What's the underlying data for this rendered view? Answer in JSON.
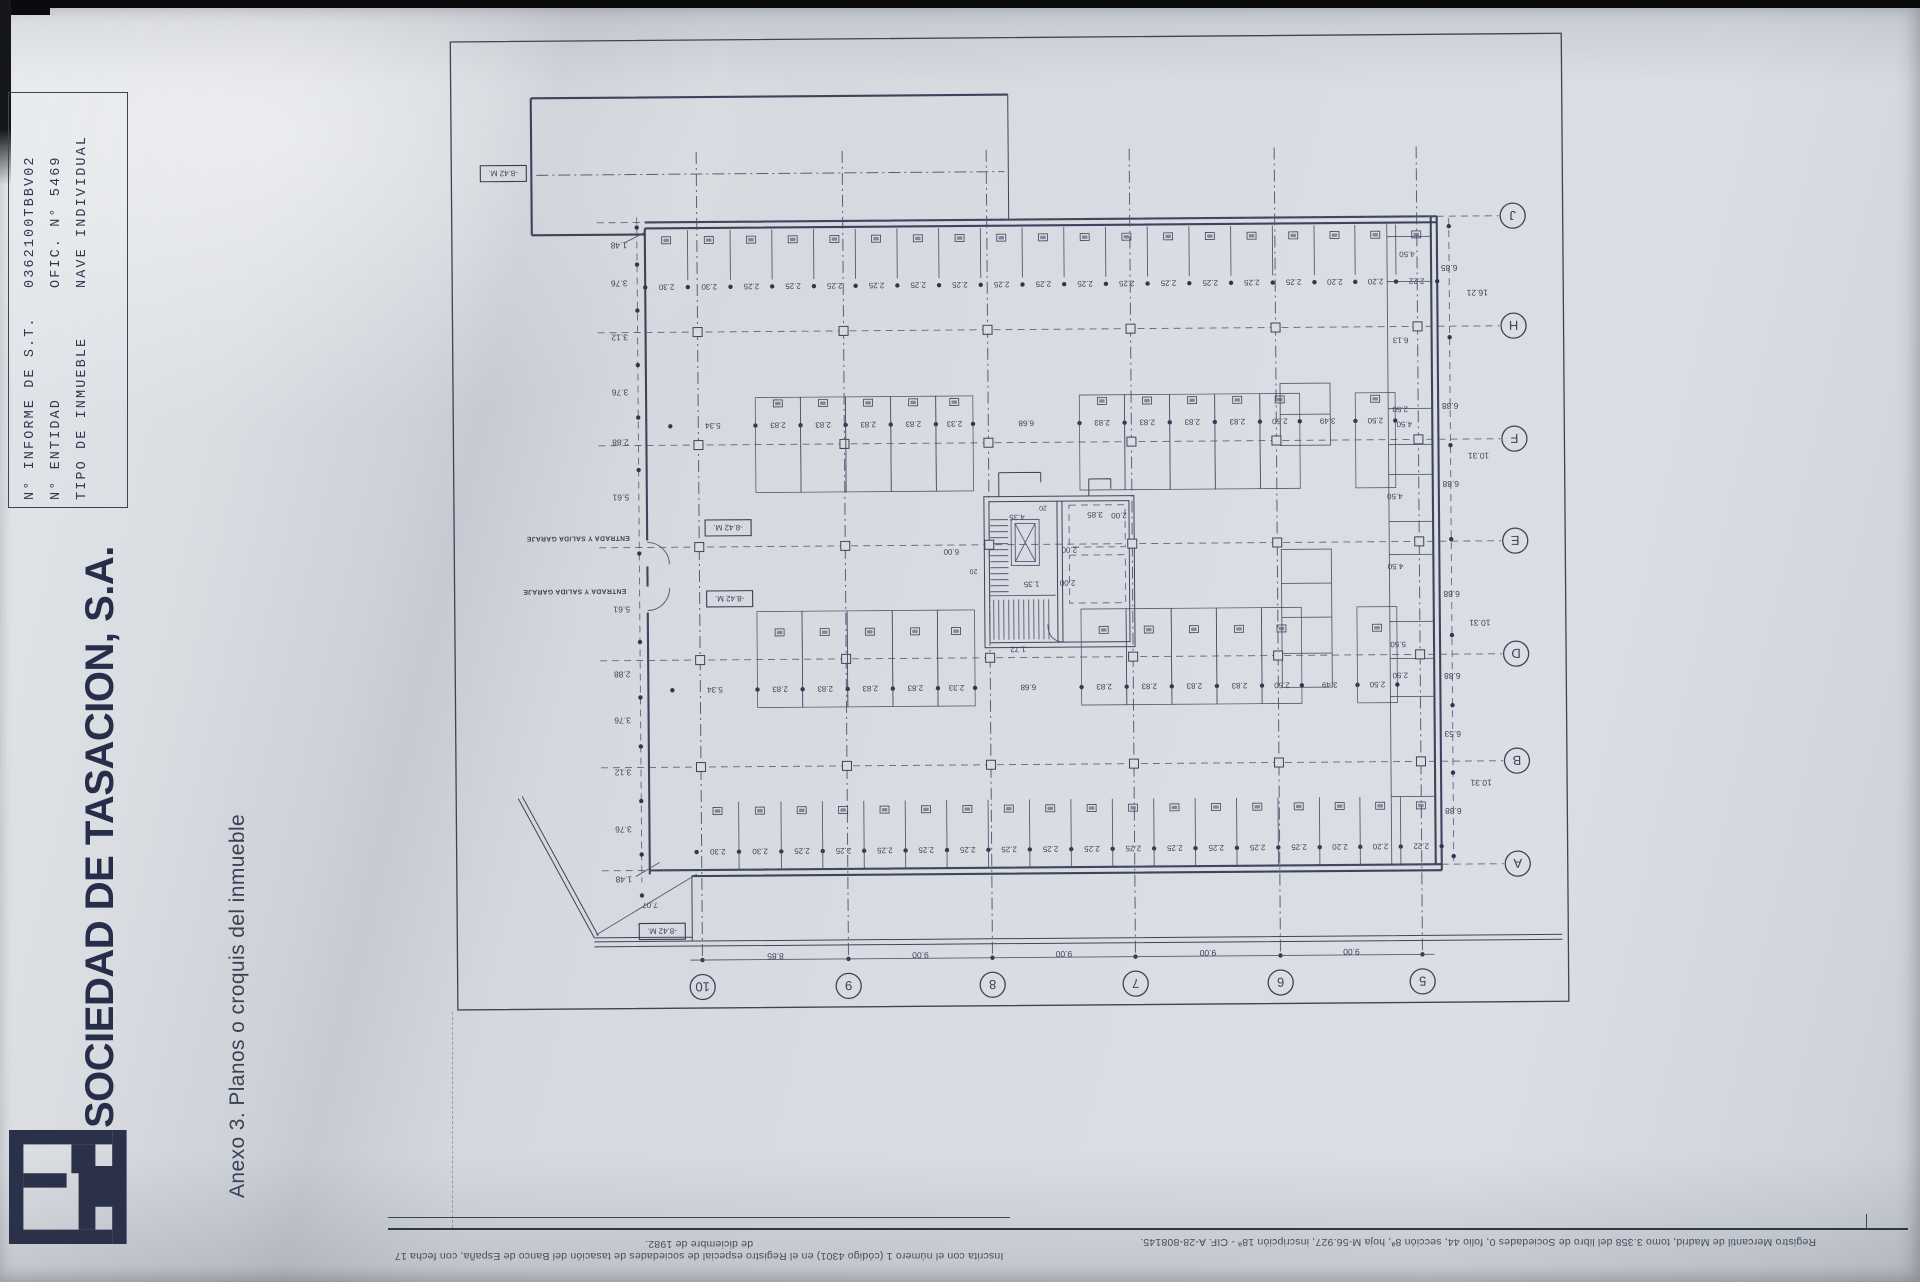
{
  "page": {
    "header": {
      "labels": [
        "N° INFORME DE S.T.",
        "N° ENTIDAD",
        "TIPO DE INMUEBLE"
      ],
      "values": [
        "0362100TBBV02",
        "OFIC. N° 5469",
        "NAVE INDIVIDUAL"
      ]
    },
    "company": "SOCIEDAD DE TASACION, S.A.",
    "annex_title": "Anexo 3. Planos o croquis del inmueble",
    "footer_left": "Inscrita con el número 1 (código 4301) en el Registro especial de sociedades de tasación del Banco de España, con fecha 17 de diciembre de 1982.",
    "footer_right": "Registro Mercantil de Madrid, tomo 3.358 del libro de Sociedades 0, folio 44, sección 8ª, hoja M-56.927, inscripción 18ª - CIF. A-28-808145."
  },
  "colors": {
    "ink": "#272e49",
    "drawing": "#3c4359"
  },
  "plan": {
    "grid_columns": [
      {
        "label": "10",
        "x": 700
      },
      {
        "label": "9",
        "x": 846
      },
      {
        "label": "8",
        "x": 990
      },
      {
        "label": "7",
        "x": 1133
      },
      {
        "label": "6",
        "x": 1278
      },
      {
        "label": "5",
        "x": 1420
      }
    ],
    "grid_rows": [
      {
        "label": "J",
        "y": 220
      },
      {
        "label": "H",
        "y": 330
      },
      {
        "label": "F",
        "y": 443
      },
      {
        "label": "E",
        "y": 545
      },
      {
        "label": "D",
        "y": 658
      },
      {
        "label": "B",
        "y": 765
      },
      {
        "label": "A",
        "y": 868
      }
    ],
    "bottom_chain": [
      "8.85",
      "9.00",
      "9.00",
      "9.00",
      "9.00"
    ],
    "right_inner_chain": [
      {
        "text": "6.85",
        "y": 272
      },
      {
        "text": "6.88",
        "y": 410
      },
      {
        "text": "6.88",
        "y": 488
      },
      {
        "text": "6.88",
        "y": 598
      },
      {
        "text": "6.88",
        "y": 680
      },
      {
        "text": "6.53",
        "y": 738
      },
      {
        "text": "6.88",
        "y": 815
      }
    ],
    "right_outer_chain": [
      {
        "text": "16.21",
        "y": 297
      },
      {
        "text": "10.31",
        "y": 460
      },
      {
        "text": "10.31",
        "y": 627
      },
      {
        "text": "10.31",
        "y": 787
      }
    ],
    "left_chain": [
      {
        "text": "1.48",
        "y": 243
      },
      {
        "text": "3.76",
        "y": 281
      },
      {
        "text": "3.12",
        "y": 335
      },
      {
        "text": "3.76",
        "y": 390
      },
      {
        "text": "2.88",
        "y": 440
      },
      {
        "text": "5.61",
        "y": 495
      },
      {
        "text": "5.61",
        "y": 607
      },
      {
        "text": "2.88",
        "y": 672
      },
      {
        "text": "3.76",
        "y": 718
      },
      {
        "text": "3.12",
        "y": 770
      },
      {
        "text": "3.76",
        "y": 827
      },
      {
        "text": "1.48",
        "y": 877
      }
    ],
    "stall_rows": [
      {
        "name": "row-J",
        "x0": 648,
        "x1": 1440,
        "top": 228,
        "bottom": 278,
        "chain_y": 285,
        "square_y": 238,
        "segments": [
          "2.30",
          "2.30",
          "2.25",
          "2.25",
          "2.25",
          "2.25",
          "2.25",
          "2.25",
          "2.25",
          "2.25",
          "2.25",
          "2.25",
          "2.25",
          "2.25",
          "2.25",
          "2.25",
          "2.20",
          "2.20",
          "2.22"
        ]
      },
      {
        "name": "band-F",
        "x0": 672,
        "x1": 1397,
        "top": 396,
        "bottom": 491,
        "chain_y": 424,
        "square_y": 402,
        "segments": [
          "5.34",
          "2.83",
          "2.83",
          "2.83",
          "2.83",
          "2.33",
          "6.68",
          "2.83",
          "2.83",
          "2.83",
          "2.83",
          "2.50",
          "3.49",
          "2.50"
        ]
      },
      {
        "name": "band-D",
        "x0": 672,
        "x1": 1397,
        "top": 610,
        "bottom": 706,
        "chain_y": 688,
        "square_y": 631,
        "segments": [
          "5.34",
          "2.83",
          "2.83",
          "2.83",
          "2.83",
          "2.33",
          "6.68",
          "2.83",
          "2.83",
          "2.83",
          "2.83",
          "2.50",
          "3.49",
          "2.50"
        ]
      },
      {
        "name": "row-A",
        "x0": 695,
        "x1": 1440,
        "top": 800,
        "bottom": 868,
        "chain_y": 850,
        "square_y": 809,
        "segments": [
          "2.30",
          "2.30",
          "2.25",
          "2.25",
          "2.25",
          "2.25",
          "2.25",
          "2.25",
          "2.25",
          "2.25",
          "2.25",
          "2.25",
          "2.25",
          "2.25",
          "2.25",
          "2.20",
          "2.20",
          "2.22"
        ]
      }
    ],
    "elevation_boxes": [
      {
        "text": "-8.42 M.",
        "x": 507,
        "y": 170
      },
      {
        "text": "-8.42 M.",
        "x": 729,
        "y": 526
      },
      {
        "text": "-8.42 M.",
        "x": 730,
        "y": 597
      },
      {
        "text": "-8.42 M.",
        "x": 660,
        "y": 929
      }
    ],
    "entrance_labels": [
      {
        "text": "ENTRADA Y SALIDA GARAJE",
        "x": 579,
        "y": 536
      },
      {
        "text": "ENTRADA Y SALIDA GARAJE",
        "x": 575,
        "y": 589
      }
    ],
    "misc_labels": [
      {
        "text": "7.07",
        "x": 648,
        "y": 903
      },
      {
        "text": "6.13",
        "x": 1403,
        "y": 344
      },
      {
        "text": "4.50",
        "x": 1410,
        "y": 258
      },
      {
        "text": "2.50",
        "x": 1402,
        "y": 413
      },
      {
        "text": "4.50",
        "x": 1406,
        "y": 428
      },
      {
        "text": "4.50",
        "x": 1396,
        "y": 500
      },
      {
        "text": "4.50",
        "x": 1396,
        "y": 570
      },
      {
        "text": "5.50",
        "x": 1398,
        "y": 648
      },
      {
        "text": "2.50",
        "x": 1400,
        "y": 679
      },
      {
        "text": "6.00",
        "x": 952,
        "y": 552
      },
      {
        "text": "4.35",
        "x": 1018,
        "y": 518
      },
      {
        "text": "3.85",
        "x": 1096,
        "y": 516
      },
      {
        "text": "2.00",
        "x": 1120,
        "y": 517
      },
      {
        "text": "2.00",
        "x": 1070,
        "y": 551
      },
      {
        "text": "2.00",
        "x": 1068,
        "y": 584
      },
      {
        "text": "1.35",
        "x": 1032,
        "y": 585
      },
      {
        "text": "20",
        "x": 974,
        "y": 572
      },
      {
        "text": "20",
        "x": 1044,
        "y": 509
      },
      {
        "text": "1.72",
        "x": 1018,
        "y": 650
      }
    ]
  }
}
